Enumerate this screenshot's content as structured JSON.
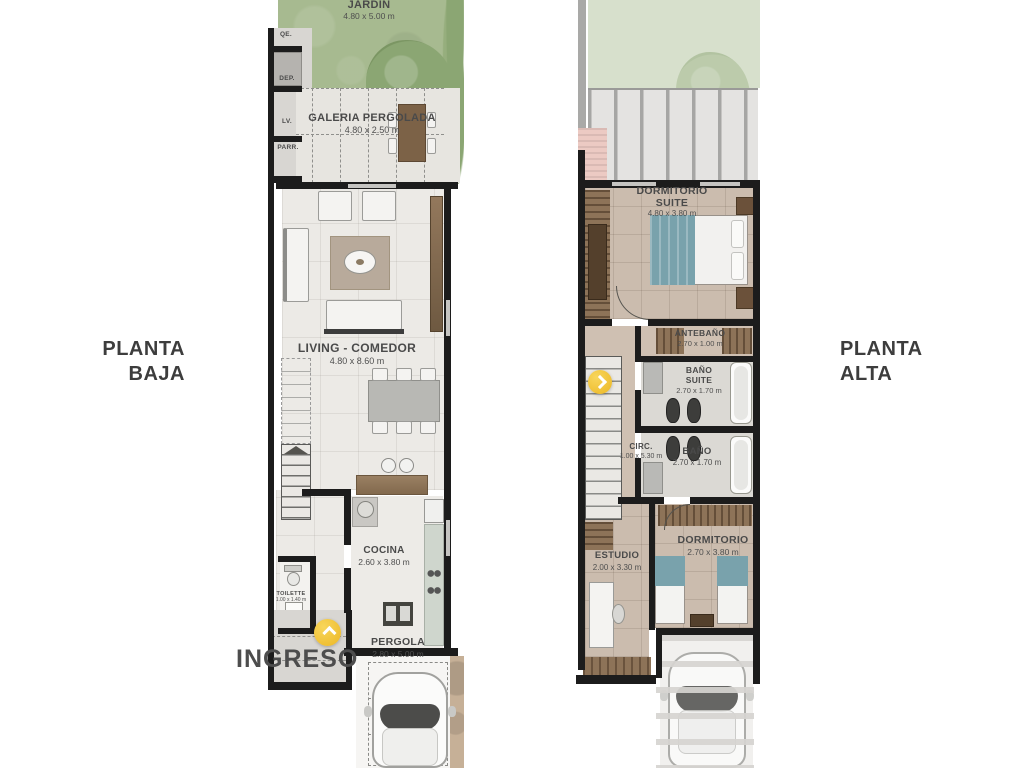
{
  "colors": {
    "accent_yellow": "#F0C230",
    "wall_black": "#1C1C1C",
    "garden_green": "#A7BA90",
    "floor_cream": "#ECEAE6",
    "floor_tan": "#CBBCAE",
    "label_gray": "#4A4A4A"
  },
  "left": {
    "title1": "PLANTA",
    "title2": "BAJA",
    "jardin": {
      "label": "JARDIN",
      "dims": "4.80 x 5.00 m"
    },
    "galeria": {
      "label": "GALERIA PERGOLADA",
      "dims": "4.80 x 2.50 m"
    },
    "living": {
      "label": "LIVING - COMEDOR",
      "dims": "4.80 x 8.60 m"
    },
    "cocina": {
      "label": "COCINA",
      "dims": "2.60 x 3.80 m"
    },
    "toilette": {
      "label": "TOILETTE",
      "dims": "1.00 x 1.40 m"
    },
    "pergola": {
      "label": "PERGOLA",
      "dims": "2.80 x 5.00 m"
    },
    "ingreso": "INGRESO",
    "util": {
      "u1": "QE.",
      "u2": "DEP.",
      "u3": "LV.",
      "u4": "PARR."
    }
  },
  "right": {
    "title1": "PLANTA",
    "title2": "ALTA",
    "suite": {
      "l1": "DORMITORIO",
      "l2": "SUITE",
      "dims": "4.80 x 3.80 m"
    },
    "antebano": {
      "label": "ANTEBAÑO",
      "dims": "2.70 x 1.00 m"
    },
    "banosuite": {
      "l1": "BAÑO",
      "l2": "SUITE",
      "dims": "2.70 x 1.70 m"
    },
    "circ": {
      "label": "CIRC.",
      "dims": "1.00 x 5.30 m"
    },
    "bano": {
      "label": "BAÑO",
      "dims": "2.70 x 1.70 m"
    },
    "dormitorio": {
      "label": "DORMITORIO",
      "dims": "2.70 x 3.80 m"
    },
    "estudio": {
      "label": "ESTUDIO",
      "dims": "2.00 x 3.30 m"
    }
  }
}
